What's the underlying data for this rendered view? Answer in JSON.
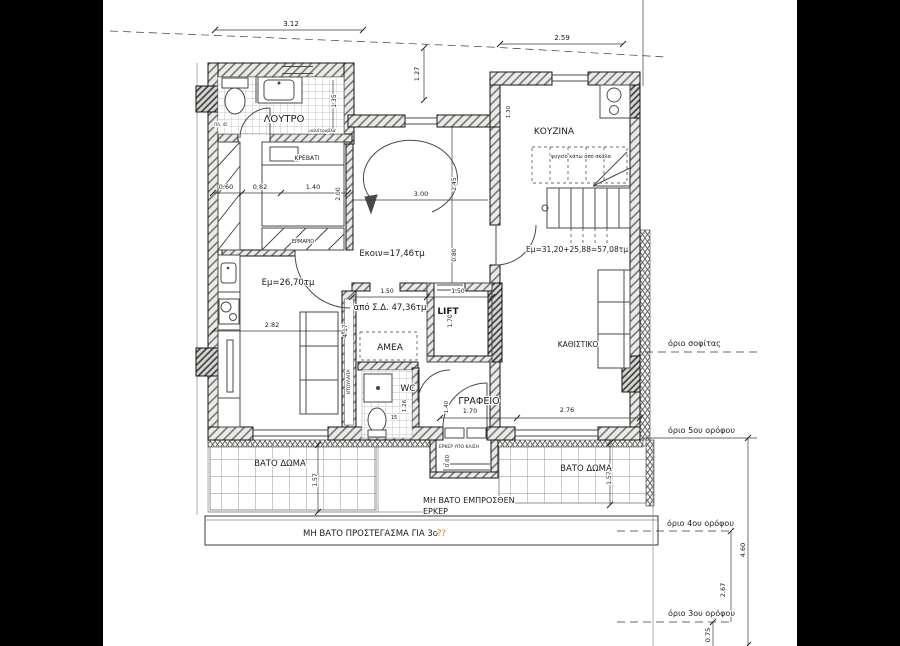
{
  "canvas": {
    "background": "#000000",
    "paper": "#ffffff"
  },
  "plan": {
    "labels": [
      {
        "id": "room-loutro",
        "text": "ΛΟΥΤΡΟ",
        "x": 284,
        "y": 122,
        "s": 10
      },
      {
        "id": "room-krevati",
        "text": "ΚΡΕΒΑΤΙ",
        "x": 307,
        "y": 160,
        "s": 6
      },
      {
        "id": "room-kouzina",
        "text": "ΚΟΥΖΙΝΑ",
        "x": 554,
        "y": 134,
        "s": 9
      },
      {
        "id": "note-fridge-under-stair",
        "text": "ψυγείο κάτω από σκάλα",
        "x": 581,
        "y": 158,
        "s": 5
      },
      {
        "id": "area-ekoin",
        "text": "Εκοιν=17,46τμ",
        "x": 392,
        "y": 256,
        "s": 8.5
      },
      {
        "id": "area-em-left",
        "text": "Εμ=26,70τμ",
        "x": 288,
        "y": 285,
        "s": 8.5
      },
      {
        "id": "area-em-right",
        "text": "Εμ=31,20+25,88=57,08τμ",
        "x": 577,
        "y": 252,
        "s": 7.5
      },
      {
        "id": "area-apo-sd",
        "text": "από Σ.Δ. 47,36τμ",
        "x": 390,
        "y": 310,
        "s": 8.5
      },
      {
        "id": "room-lift",
        "text": "LIFT",
        "x": 448,
        "y": 314,
        "s": 9,
        "w": "bold"
      },
      {
        "id": "room-amea",
        "text": "ΑΜΕΑ",
        "x": 390,
        "y": 350,
        "s": 9
      },
      {
        "id": "room-wc",
        "text": "WC",
        "x": 408,
        "y": 391,
        "s": 9
      },
      {
        "id": "room-grafeio",
        "text": "ΓΡΑΦΕΙΟ",
        "x": 479,
        "y": 404,
        "s": 9.5
      },
      {
        "id": "room-kathistiko",
        "text": "ΚΑΘΙΣΤΙΚΟ",
        "x": 578,
        "y": 347,
        "s": 7.5
      },
      {
        "id": "note-erker-ypo-klisi",
        "text": "ΕΡΚΕΡ ΥΠΟ ΚΛΙΣΗ",
        "x": 459,
        "y": 448,
        "s": 4.5
      },
      {
        "id": "terrace-vato-doma-left",
        "text": "ΒΑΤΟ ΔΩΜΑ",
        "x": 280,
        "y": 466,
        "s": 8.5
      },
      {
        "id": "terrace-vato-doma-right",
        "text": "ΒΑΤΟ ΔΩΜΑ",
        "x": 586,
        "y": 471,
        "s": 8.5
      },
      {
        "id": "note-mi-vato-line1",
        "text": "ΜΗ ΒΑΤΟ ΕΜΠΡΟΣΘΕΝ",
        "x": 423,
        "y": 503,
        "s": 8,
        "a": "start"
      },
      {
        "id": "note-mi-vato-line2",
        "text": "ΕΡΚΕΡ",
        "x": 423,
        "y": 514,
        "s": 8,
        "a": "start"
      },
      {
        "id": "note-prostegasma",
        "text": "ΜΗ ΒΑΤΟ ΠΡΟΣΤΕΓΑΣΜΑ ΓΙΑ 3ο",
        "x": 303,
        "y": 536,
        "s": 8.5,
        "a": "start"
      },
      {
        "id": "note-prostegasma-unknown",
        "text": "??",
        "x": 437,
        "y": 536,
        "s": 8.5,
        "a": "start",
        "c": "#e0801e"
      },
      {
        "id": "limit-sofitas",
        "text": "όριο σοφίτας",
        "x": 668,
        "y": 346,
        "s": 8,
        "a": "start"
      },
      {
        "id": "limit-5th-floor",
        "text": "όριο 5ου ορόφου",
        "x": 668,
        "y": 433,
        "s": 8,
        "a": "start"
      },
      {
        "id": "limit-4th-floor",
        "text": "όριο 4ου ορόφου",
        "x": 667,
        "y": 526,
        "s": 8,
        "a": "start"
      },
      {
        "id": "limit-3rd-floor",
        "text": "όριο 3ου ορόφου",
        "x": 668,
        "y": 616,
        "s": 8,
        "a": "start"
      },
      {
        "id": "note-ermario",
        "text": "ΕΡΜΑΡΙΟ",
        "x": 303,
        "y": 243,
        "s": 5
      },
      {
        "id": "note-ntoulapa",
        "text": "ΝΤΟΥΛΑΠΑ",
        "x": 350,
        "y": 382,
        "s": 4.5,
        "r": -90
      },
      {
        "id": "note-yalotouvla",
        "text": "υαλότουβλα",
        "x": 322,
        "y": 132,
        "s": 4.5
      },
      {
        "id": "note-plate-45",
        "text": "ΠΛ. 45",
        "x": 221,
        "y": 126,
        "s": 4
      }
    ],
    "dimensions": [
      {
        "id": "dim-3-12",
        "text": "3.12",
        "x": 291,
        "y": 26,
        "s": 7
      },
      {
        "id": "dim-2-59",
        "text": "2.59",
        "x": 562,
        "y": 40,
        "s": 7
      },
      {
        "id": "dim-1-27",
        "text": "1.27",
        "x": 419,
        "y": 74,
        "s": 6.5,
        "r": -90
      },
      {
        "id": "dim-1-35",
        "text": "1.35",
        "x": 336,
        "y": 101,
        "s": 6,
        "r": -90
      },
      {
        "id": "dim-1-30",
        "text": "1.30",
        "x": 510,
        "y": 112,
        "s": 5.5,
        "r": -90
      },
      {
        "id": "dim-0-60-a",
        "text": "0.60",
        "x": 226,
        "y": 189,
        "s": 6.5
      },
      {
        "id": "dim-0-82",
        "text": "0.82",
        "x": 260,
        "y": 189,
        "s": 6.5
      },
      {
        "id": "dim-1-40-a",
        "text": "1.40",
        "x": 313,
        "y": 189,
        "s": 6.5
      },
      {
        "id": "dim-2-00",
        "text": "2.00",
        "x": 340,
        "y": 194,
        "s": 6,
        "r": -90
      },
      {
        "id": "dim-3-00",
        "text": "3.00",
        "x": 421,
        "y": 196,
        "s": 6.5
      },
      {
        "id": "dim-2-45",
        "text": "2.45",
        "x": 456,
        "y": 184,
        "s": 6,
        "r": -90
      },
      {
        "id": "dim-0-80",
        "text": "0.80",
        "x": 456,
        "y": 255,
        "s": 6,
        "r": -90
      },
      {
        "id": "dim-1-50-a",
        "text": "1.50",
        "x": 387,
        "y": 293,
        "s": 6
      },
      {
        "id": "dim-1-50-b",
        "text": "1.50",
        "x": 458,
        "y": 293,
        "s": 6
      },
      {
        "id": "dim-1-70-a",
        "text": "1.70",
        "x": 452,
        "y": 321,
        "s": 6,
        "r": -90
      },
      {
        "id": "dim-2-82",
        "text": "2.82",
        "x": 272,
        "y": 327,
        "s": 6.5
      },
      {
        "id": "dim-4-17",
        "text": "4.17",
        "x": 347,
        "y": 331,
        "s": 6,
        "r": -90
      },
      {
        "id": "dim-1-26",
        "text": "1.26",
        "x": 406,
        "y": 406,
        "s": 5.5,
        "r": -90
      },
      {
        "id": "dim-15",
        "text": "15",
        "x": 394,
        "y": 419,
        "s": 5
      },
      {
        "id": "dim-1-40-b",
        "text": "1.40",
        "x": 448,
        "y": 407,
        "s": 5.5,
        "r": -90
      },
      {
        "id": "dim-1-70-b",
        "text": "1.70",
        "x": 470,
        "y": 413,
        "s": 6.5
      },
      {
        "id": "dim-2-76",
        "text": "2.76",
        "x": 567,
        "y": 412,
        "s": 6.5
      },
      {
        "id": "dim-0-60-b",
        "text": "0.60",
        "x": 449,
        "y": 461,
        "s": 5.5,
        "r": -90
      },
      {
        "id": "dim-1-57-a",
        "text": "1.57",
        "x": 317,
        "y": 480,
        "s": 6,
        "r": -90
      },
      {
        "id": "dim-1-57-b",
        "text": "1.57",
        "x": 611,
        "y": 478,
        "s": 6,
        "r": -90
      },
      {
        "id": "dim-4-60",
        "text": "4.60",
        "x": 745,
        "y": 550,
        "s": 6.5,
        "r": -90
      },
      {
        "id": "dim-2-67",
        "text": "2.67",
        "x": 725,
        "y": 590,
        "s": 6.5,
        "r": -90
      },
      {
        "id": "dim-0-75",
        "text": "0.75",
        "x": 710,
        "y": 635,
        "s": 6.5,
        "r": -90
      }
    ]
  }
}
